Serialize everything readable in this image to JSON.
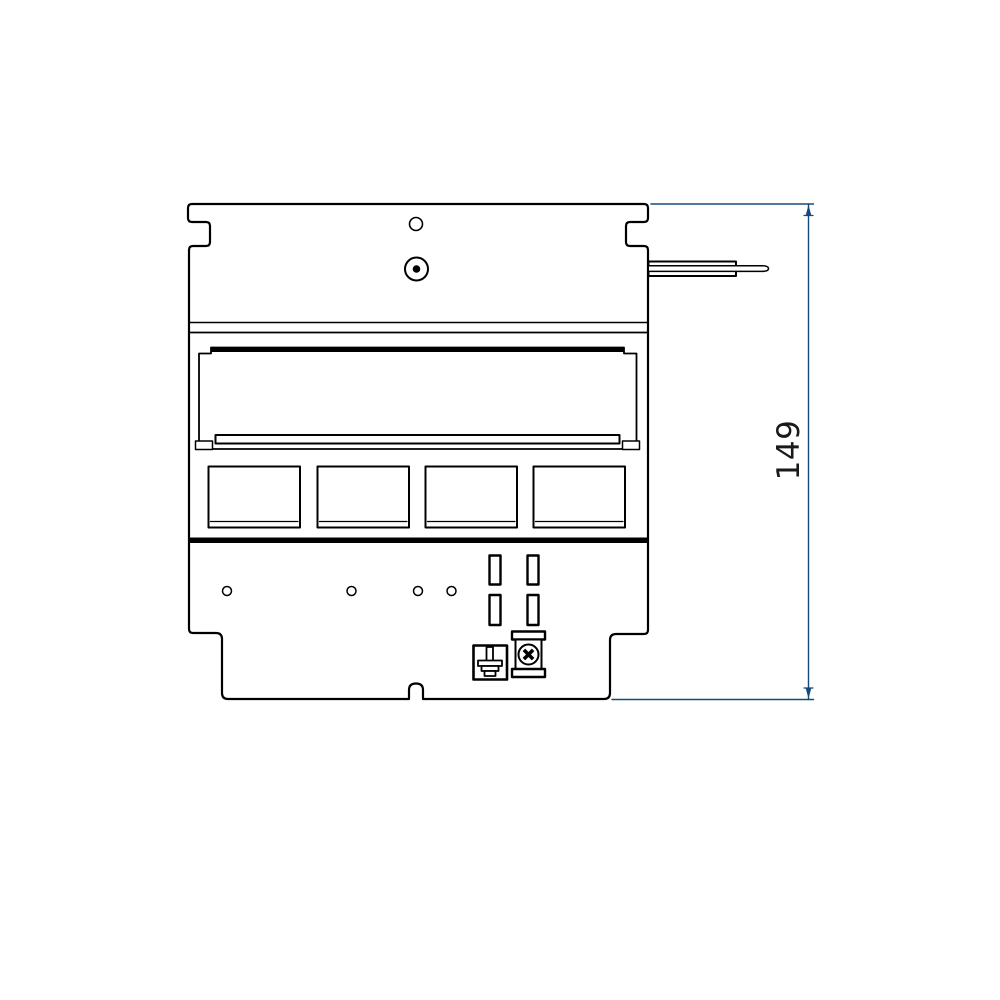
{
  "page": {
    "background": "#ffffff"
  },
  "drawing": {
    "kind": "technical-drawing-front-view",
    "ink_color": "#000000",
    "parts": [
      "mounting-plate-outline",
      "side-notch-left",
      "side-notch-right",
      "pilot-hole",
      "screw-grommet",
      "lever-rod",
      "separator-lines",
      "cover-opening",
      "cover-top-bar",
      "support-rail",
      "module-cutout-1",
      "module-cutout-2",
      "module-cutout-3",
      "module-cutout-4",
      "thick-divider",
      "mounting-hole-1",
      "mounting-hole-2",
      "mounting-hole-3",
      "mounting-hole-4",
      "vent-slot-1",
      "vent-slot-2",
      "vent-slot-3",
      "vent-slot-4",
      "earth-terminal",
      "screw-terminal",
      "bottom-center-notch"
    ]
  },
  "dimension": {
    "label": "149",
    "color": "#174a7c",
    "text_color": "#1a1a1a",
    "axis": "vertical"
  }
}
